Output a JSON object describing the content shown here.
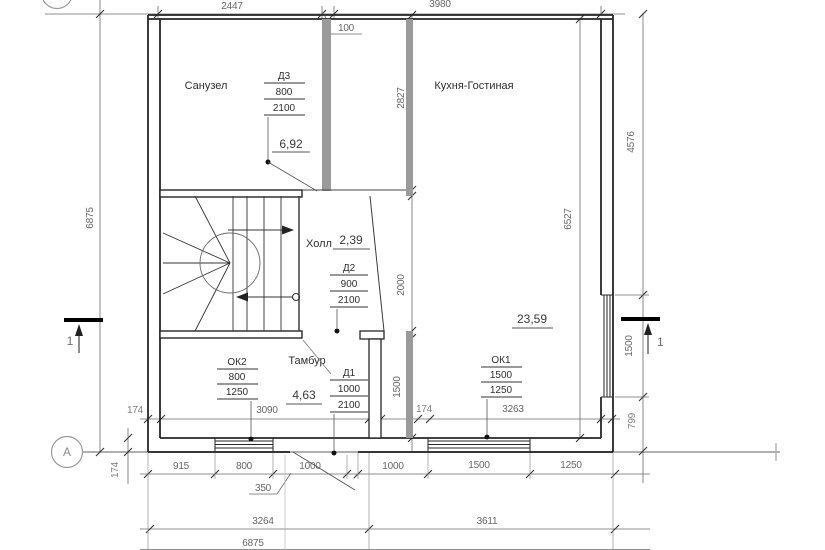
{
  "rooms": {
    "sanuzel": {
      "name": "Санузел",
      "area": "6,92"
    },
    "kitchen": {
      "name": "Кухня-Гостиная",
      "area": "23,59"
    },
    "hall": {
      "name": "Холл",
      "area": "2,39"
    },
    "tambour": {
      "name": "Тамбур",
      "area": "4,63"
    }
  },
  "doors": {
    "d3": {
      "tag": "Д3",
      "width": "800",
      "height": "2100"
    },
    "d2": {
      "tag": "Д2",
      "width": "900",
      "height": "2100"
    },
    "d1": {
      "tag": "Д1",
      "width": "1000",
      "height": "2100"
    }
  },
  "windows": {
    "ok2": {
      "tag": "ОК2",
      "width": "800",
      "height": "1250"
    },
    "ok1": {
      "tag": "ОК1",
      "width": "1500",
      "height": "1250"
    }
  },
  "dimensions": {
    "top": {
      "left": "2447",
      "partition": "100",
      "right": "3980"
    },
    "row1": {
      "a": "174",
      "b": "3090",
      "c": "174",
      "d": "3263"
    },
    "row2": {
      "a": "915",
      "b": "800",
      "c": "1000",
      "d": "1000",
      "e": "1500",
      "f": "1250"
    },
    "row3": {
      "a": "3264",
      "b": "3611"
    },
    "total": "6875",
    "left": {
      "total": "6875",
      "wall": "174"
    },
    "mid": {
      "a": "2827",
      "b": "2000",
      "c": "1500"
    },
    "kitchen_inner": "6527",
    "right": {
      "a": "4576",
      "b": "1500",
      "c": "799"
    },
    "note": "350"
  },
  "axes": {
    "row_a": "А",
    "section": "1"
  }
}
